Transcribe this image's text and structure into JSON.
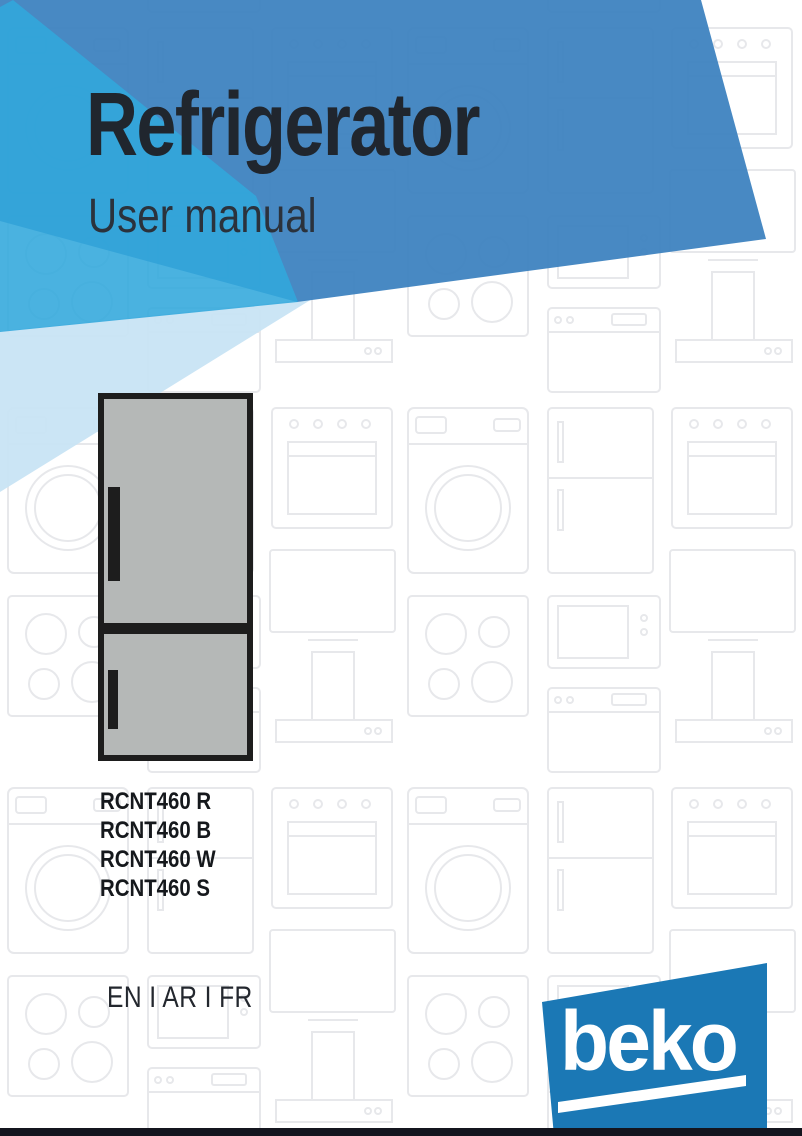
{
  "header": {
    "title": "Refrigerator",
    "subtitle": "User manual"
  },
  "product": {
    "models": [
      "RCNT460 R",
      "RCNT460 B",
      "RCNT460 W",
      "RCNT460 S"
    ]
  },
  "languages": "EN I AR I FR",
  "brand": {
    "name": "beko"
  },
  "colors": {
    "main_blue": "#3a80be",
    "cyan_blue": "#31a7dc",
    "pale_blue": "#c8e4f4",
    "brand_blue": "#1b78b5",
    "fridge_gray": "#b5b8b7",
    "footer_bar": "#14151e"
  }
}
